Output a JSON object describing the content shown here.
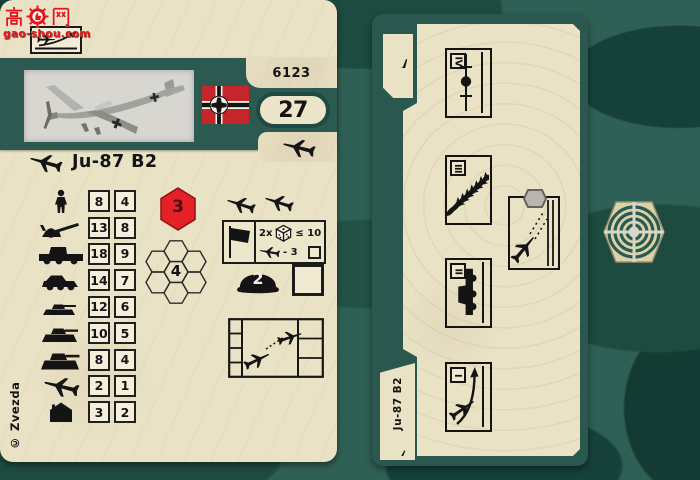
{
  "watermark": {
    "site": "gao-shou.com",
    "logo_text": "高网"
  },
  "front_card": {
    "product_number": "6123",
    "points": "27",
    "unit_name": "Ju-87 B2",
    "movement": "3",
    "range": "4",
    "defense": "2",
    "attack_rows": [
      {
        "target": "infantry",
        "full": "8",
        "reduced": "4"
      },
      {
        "target": "gun",
        "full": "13",
        "reduced": "8"
      },
      {
        "target": "truck",
        "full": "18",
        "reduced": "9"
      },
      {
        "target": "armored-car",
        "full": "14",
        "reduced": "7"
      },
      {
        "target": "light-tank",
        "full": "12",
        "reduced": "6"
      },
      {
        "target": "medium-tank",
        "full": "10",
        "reduced": "5"
      },
      {
        "target": "heavy-tank",
        "full": "8",
        "reduced": "4"
      },
      {
        "target": "aircraft",
        "full": "2",
        "reduced": "1"
      },
      {
        "target": "building",
        "full": "3",
        "reduced": "2"
      }
    ],
    "attack_rule": {
      "dice_multiplier": "2x",
      "dice_threshold": "≤ 10",
      "aircraft_modifier": "- 3"
    },
    "copyright": "© Zvezda"
  },
  "back_card": {
    "unit_name": "Ju-87 B2",
    "phases": [
      {
        "numeral": "IV"
      },
      {
        "numeral": "III"
      },
      {
        "numeral": "II"
      },
      {
        "numeral": "I"
      }
    ]
  },
  "colors": {
    "camo_base": "#2f6055",
    "camo_dark": "#1c4a40",
    "card_cream": "#e9e2c4",
    "band_green": "#2d5a50",
    "hex_red": "#e32127",
    "flag_red": "#c4262b"
  }
}
